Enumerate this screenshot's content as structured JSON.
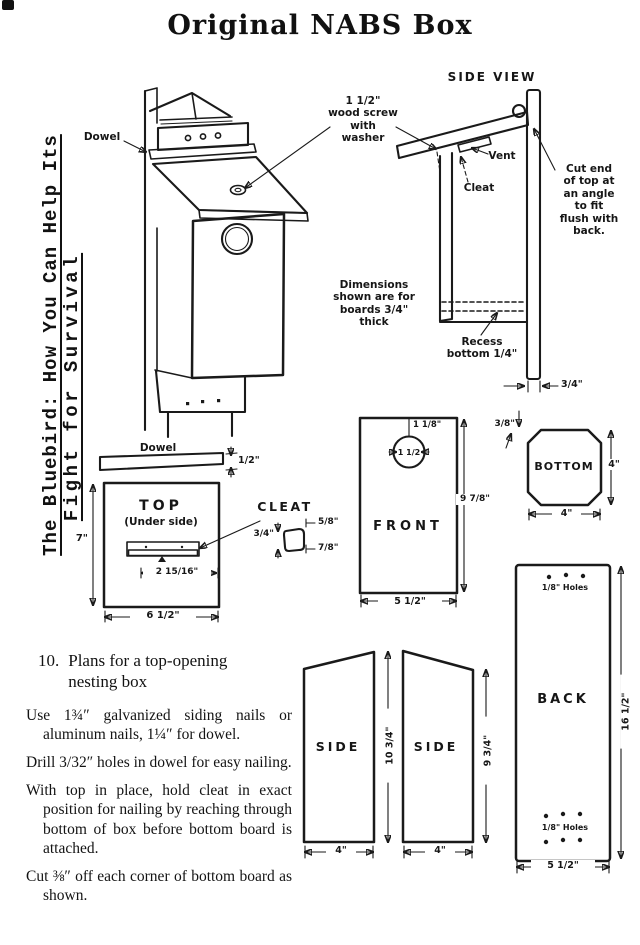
{
  "title": "Original NABS Box",
  "spine": {
    "line1": "The Bluebird: How You Can Help Its",
    "line2": "Fight for Survival"
  },
  "side_view": {
    "title": "SIDE VIEW",
    "screw_note": "1 1/2\"\nwood screw\nwith\nwasher",
    "vent": "Vent",
    "cleat": "Cleat",
    "cut_end_note": "Cut end\nof top at\nan angle\nto fit\nflush with\nback.",
    "board_note": "Dimensions\nshown are for\nboards 3/4\"\nthick",
    "recess_note": "Recess\nbottom 1/4\"",
    "back_thickness": "3/4\""
  },
  "main_view": {
    "dowel": "Dowel"
  },
  "dowel_piece": {
    "label": "Dowel",
    "thickness": "1/2\""
  },
  "top_piece": {
    "label": "TOP",
    "sublabel": "(Under side)",
    "depth": "7\"",
    "width": "6 1/2\"",
    "cleat_offset": "2 15/16\""
  },
  "cleat_piece": {
    "label": "CLEAT",
    "top_width": "5/8\"",
    "height": "3/4\"",
    "bottom_width": "7/8\""
  },
  "front_piece": {
    "label": "FRONT",
    "hole_offset": "1 1/8\"",
    "hole_diameter": "1 1/2",
    "height": "9 7/8\"",
    "width": "5 1/2\""
  },
  "bottom_piece": {
    "label": "BOTTOM",
    "corner_cut": "3/8\"",
    "depth": "4\"",
    "width": "4\""
  },
  "back_piece": {
    "label": "BACK",
    "top_holes": "1/8\" Holes",
    "bottom_holes": "1/8\" Holes",
    "height": "16 1/2\"",
    "width": "5 1/2\""
  },
  "side_pieces": {
    "left_label": "SIDE",
    "right_label": "SIDE",
    "left_width": "4\"",
    "right_width": "4\"",
    "front_height": "10 3/4\"",
    "back_height": "9 3/4\""
  },
  "instructions": {
    "number": "10.",
    "heading": "Plans for a top-opening\nnesting box",
    "items": [
      "Use 1¾″ galvanized siding nails or aluminum nails, 1¼″ for dowel.",
      "Drill 3/32″ holes in dowel for easy nailing.",
      "With top in place, hold cleat in exact position for nailing by reaching through bottom of box before bottom board is attached.",
      "Cut ⅜″ off each corner of bottom board as shown."
    ]
  }
}
